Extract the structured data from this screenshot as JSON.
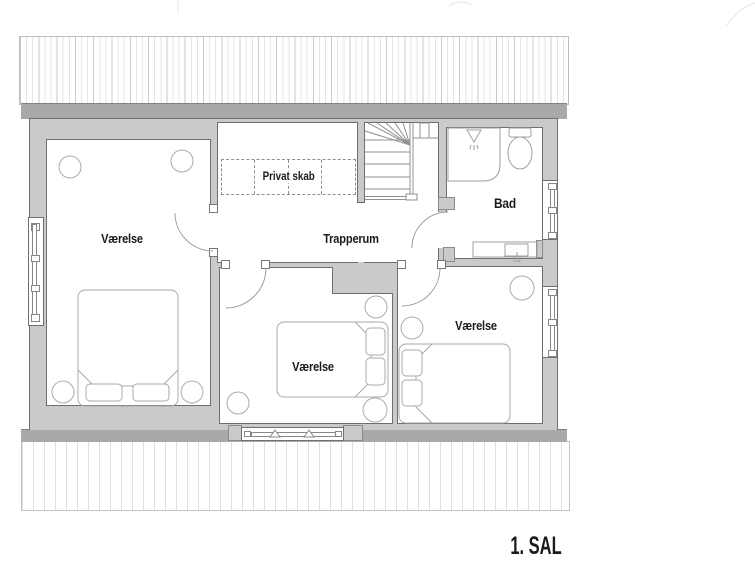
{
  "floor_plan": {
    "title": "1. SAL",
    "rooms": {
      "bedroom_left": {
        "label": "Værelse"
      },
      "bedroom_middle": {
        "label": "Værelse"
      },
      "bedroom_right": {
        "label": "Værelse"
      },
      "stairwell": {
        "label": "Trapperum"
      },
      "bathroom": {
        "label": "Bad"
      },
      "closet": {
        "label": "Privat skab"
      }
    },
    "colors": {
      "wall_fill": "#cacaca",
      "fascia": "#a9a9a9",
      "outline": "#707070",
      "furniture_line": "#a9a9a9",
      "stair_line": "#909090",
      "text": "#1b1b1b"
    }
  }
}
